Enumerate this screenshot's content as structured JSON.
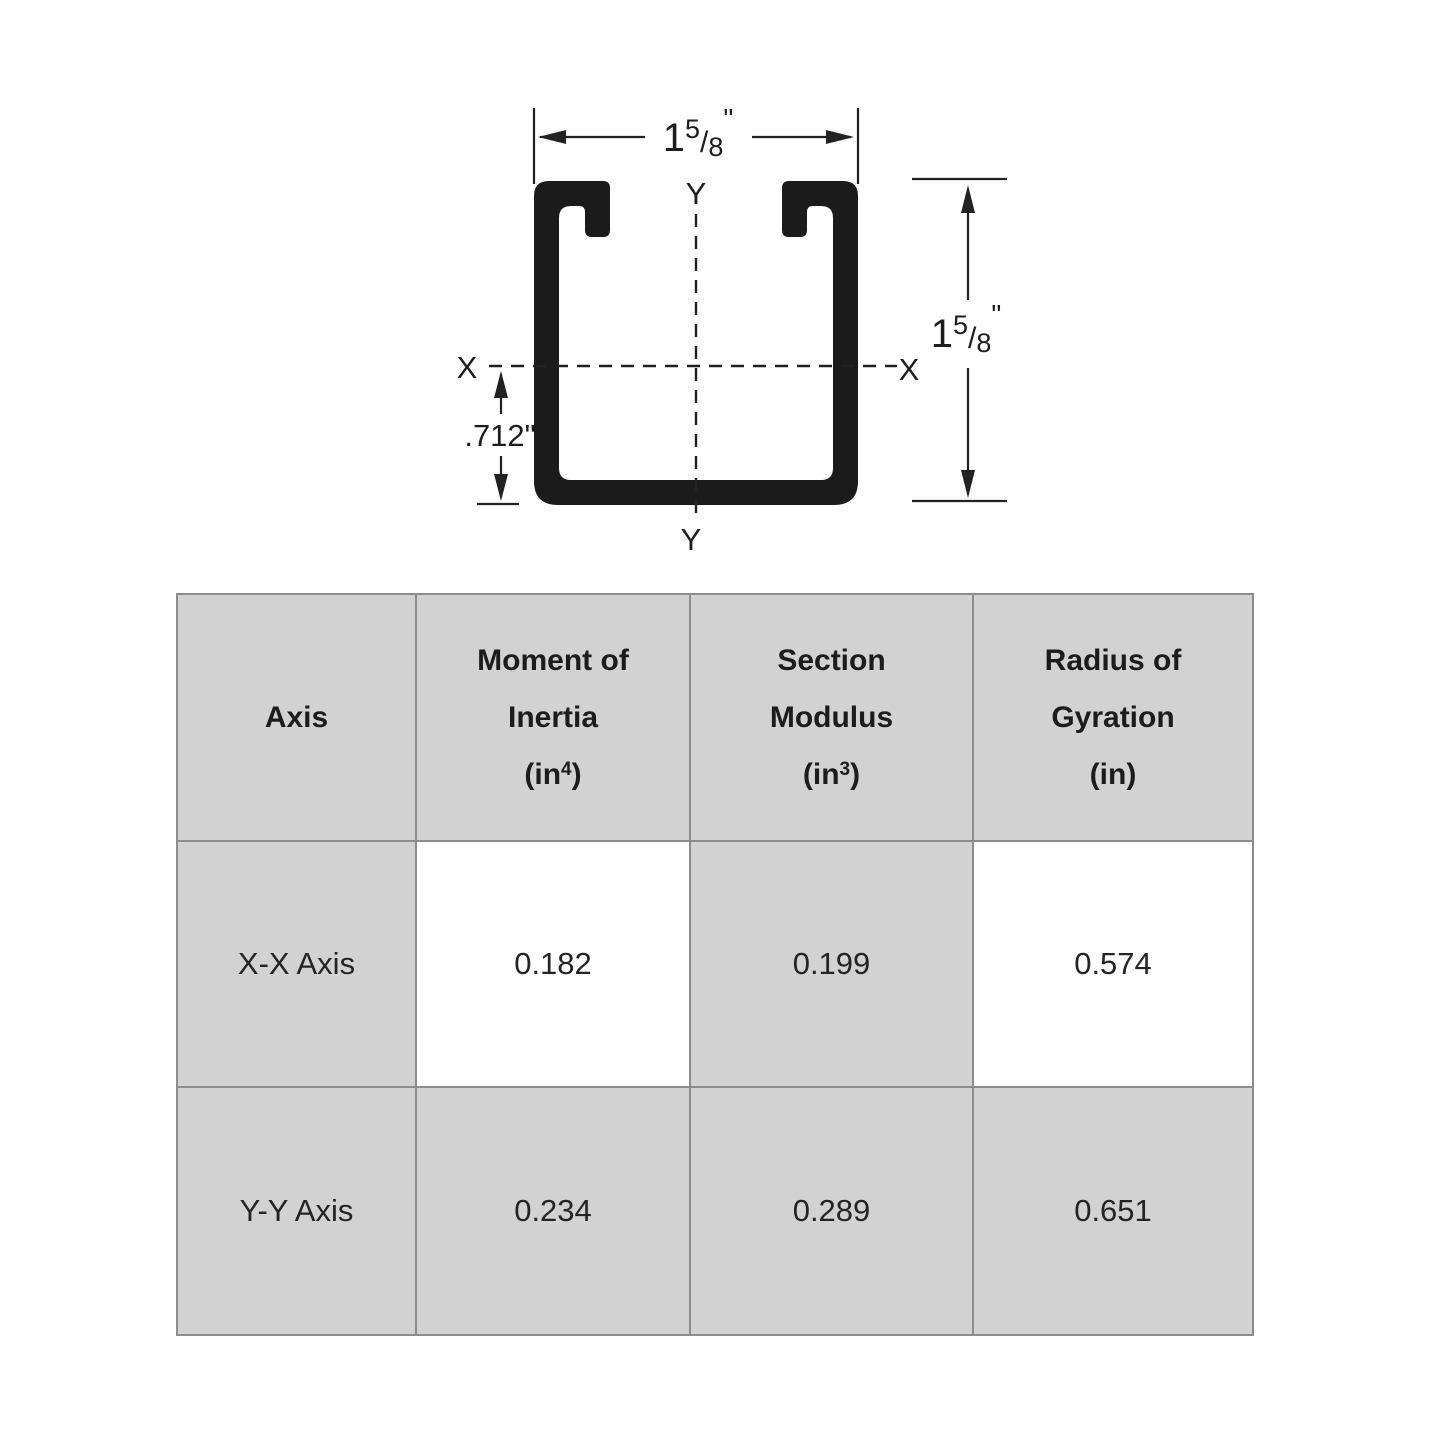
{
  "diagram": {
    "width_dim": {
      "whole": "1",
      "numerator": "5",
      "slash": "/",
      "denominator": "8",
      "unit": "\""
    },
    "height_dim": {
      "whole": "1",
      "numerator": "5",
      "slash": "/",
      "denominator": "8",
      "unit": "\""
    },
    "offset_dim_label": ".712\"",
    "axis": {
      "x_left": "X",
      "x_right": "X",
      "y_top": "Y",
      "y_bottom": "Y"
    }
  },
  "table": {
    "header": {
      "axis": "Axis",
      "col2": {
        "line1": "Moment of",
        "line2": "Inertia",
        "unit_open": "(in",
        "unit_sup": "4",
        "unit_close": ")"
      },
      "col3": {
        "line1": "Section",
        "line2": "Modulus",
        "unit_open": "(in",
        "unit_sup": "3",
        "unit_close": ")"
      },
      "col4": {
        "line1": "Radius of",
        "line2": "Gyration",
        "unit_open": "(in",
        "unit_sup": "",
        "unit_close": ")"
      }
    },
    "rows": [
      {
        "axis": "X-X Axis",
        "moment_of_inertia": "0.182",
        "section_modulus": "0.199",
        "radius_of_gyration": "0.574"
      },
      {
        "axis": "Y-Y Axis",
        "moment_of_inertia": "0.234",
        "section_modulus": "0.289",
        "radius_of_gyration": "0.651"
      }
    ]
  },
  "colors": {
    "ink": "#1d1d1d",
    "table_cell_gray": "#d2d2d2",
    "table_grid": "#8c8c8c",
    "background": "#ffffff"
  }
}
